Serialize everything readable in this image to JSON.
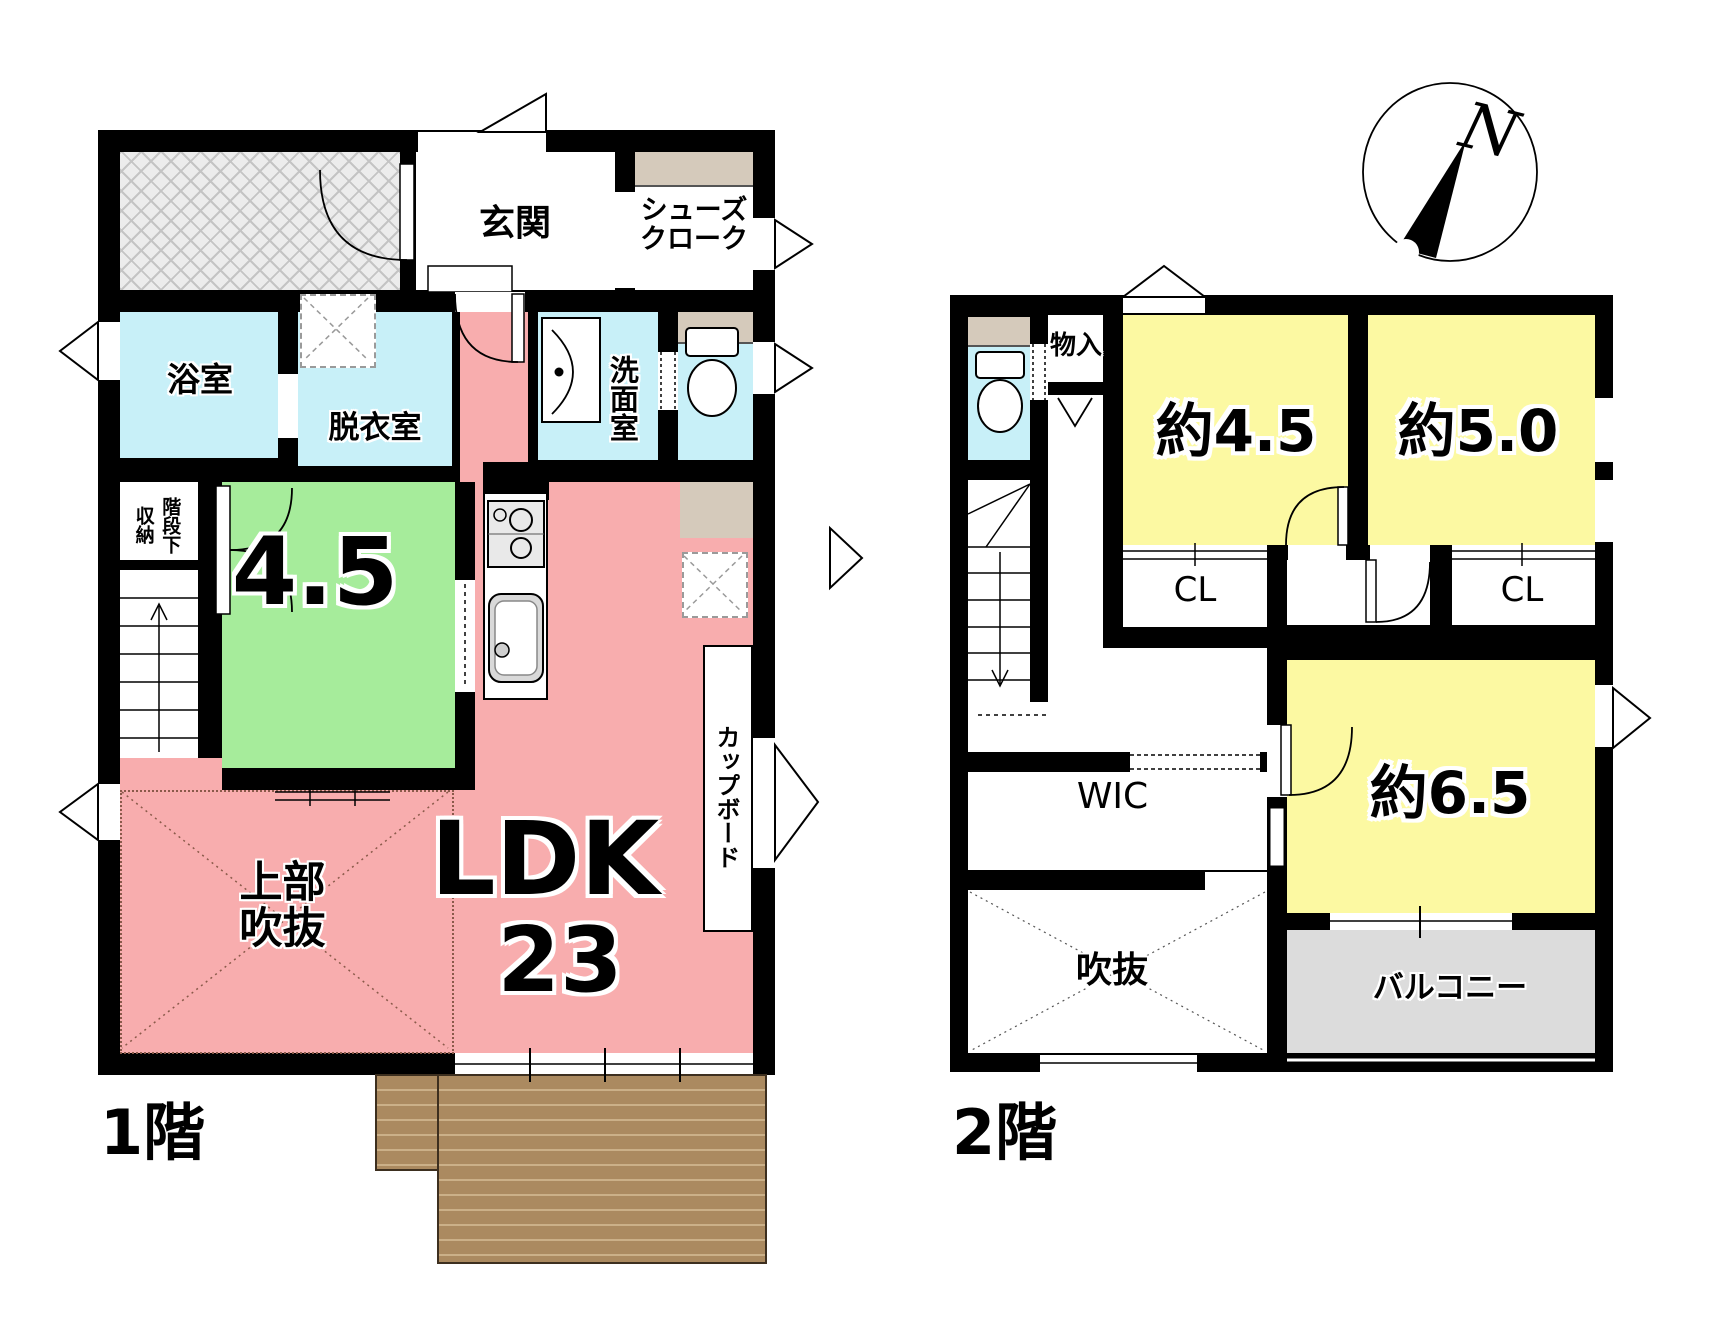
{
  "title": "間取り図",
  "compass": {
    "label": "N"
  },
  "floor1": {
    "floor_label": "1階",
    "genkan": "玄関",
    "shoes_closet_line1": "シューズ",
    "shoes_closet_line2": "クローク",
    "bathroom": "浴室",
    "dressing_room": "脱衣室",
    "washroom": "洗面室",
    "under_stairs_line1": "階段下",
    "under_stairs_line2": "収納",
    "tatami_room_size": "4.5",
    "ldk_label": "LDK",
    "ldk_size": "23",
    "cupboard": "カップボード",
    "atrium_upper_line1": "上部",
    "atrium_upper_line2": "吹抜"
  },
  "floor2": {
    "floor_label": "2階",
    "storage": "物入",
    "bedroom_a_size": "約4.5",
    "bedroom_b_size": "約5.0",
    "bedroom_c_size": "約6.5",
    "closet_a": "CL",
    "closet_b": "CL",
    "walk_in_closet": "WIC",
    "atrium": "吹抜",
    "balcony": "バルコニー"
  },
  "colors": {
    "wall": "#000000",
    "ldk_pink": "#f8adae",
    "tatami_green": "#a6ec9b",
    "wet_area_blue": "#c8f0f8",
    "bedroom_yellow": "#fcf9a2",
    "shelf_tan": "#d5cabb",
    "balcony_gray": "#dcdcdc",
    "deck_brown": "#ab8a60",
    "porch_hatch_gray": "#ececec"
  }
}
